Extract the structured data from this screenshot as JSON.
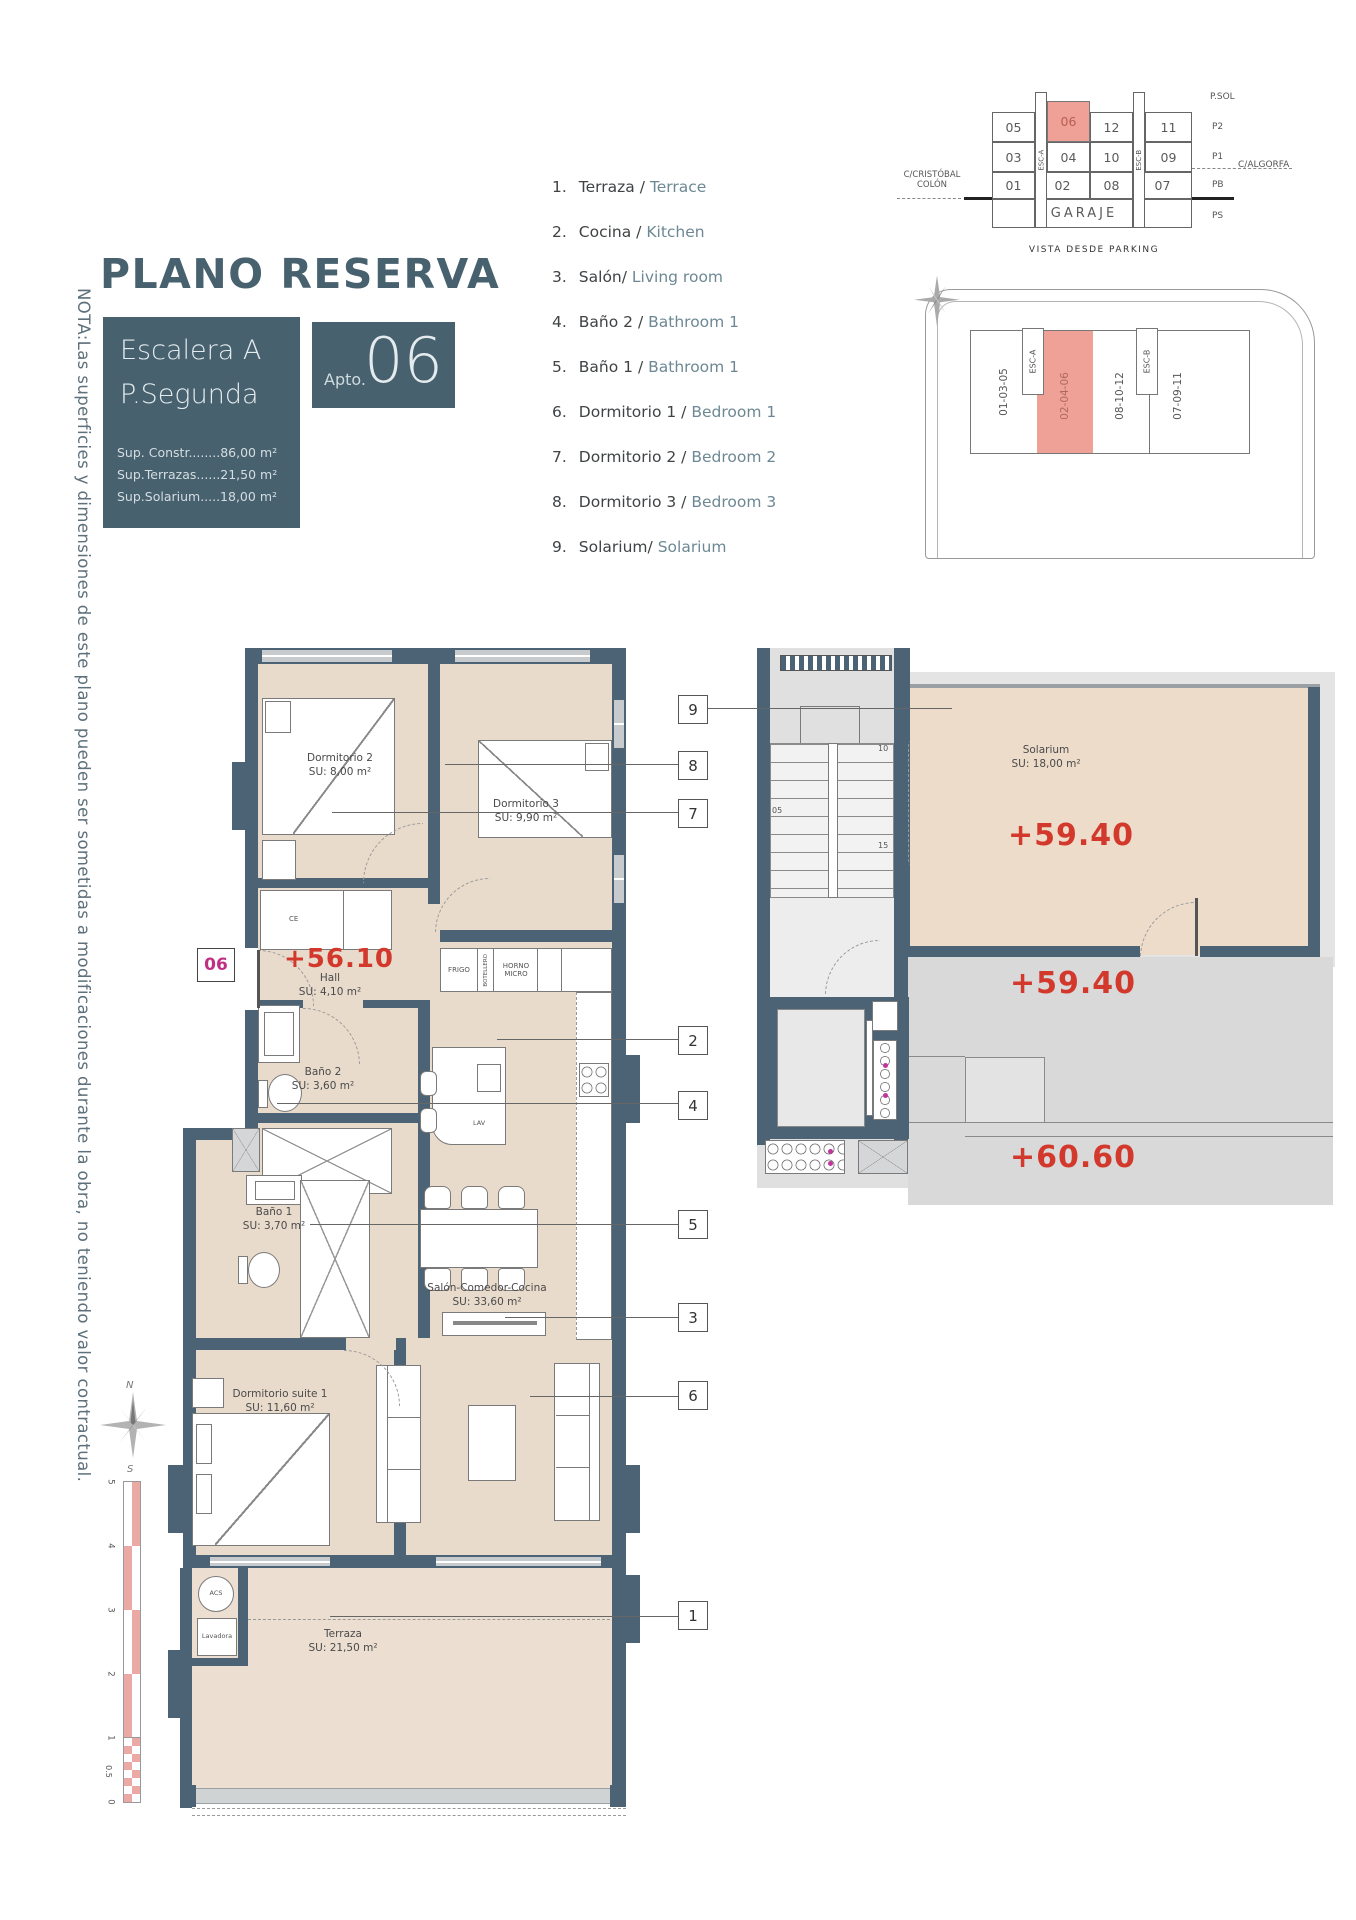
{
  "title": "PLANO RESERVA",
  "note": "NOTA:Las superficies y dimensiones de este plano pueden ser sometidas a modificaciones durante la obra, no teniendo valor contractual.",
  "info_box": {
    "escalera": "Escalera A",
    "planta": "P.Segunda",
    "sup_constr": "Sup. Constr........86,00 m²",
    "sup_terrazas": "Sup.Terrazas......21,50 m²",
    "sup_solarium": "Sup.Solarium.....18,00 m²"
  },
  "apto": {
    "label": "Apto.",
    "number": "06"
  },
  "legend": {
    "items": [
      {
        "num": "1.",
        "es": "Terraza /",
        "en": "Terrace"
      },
      {
        "num": "2.",
        "es": "Cocina /",
        "en": "Kitchen"
      },
      {
        "num": "3.",
        "es": "Salón/",
        "en": "Living room"
      },
      {
        "num": "4.",
        "es": "Baño 2 /",
        "en": "Bathroom 1"
      },
      {
        "num": "5.",
        "es": "Baño 1 /",
        "en": "Bathroom 1"
      },
      {
        "num": "6.",
        "es": "Dormitorio 1 /",
        "en": "Bedroom 1"
      },
      {
        "num": "7.",
        "es": "Dormitorio 2 /",
        "en": "Bedroom 2"
      },
      {
        "num": "8.",
        "es": "Dormitorio 3 /",
        "en": "Bedroom 3"
      },
      {
        "num": "9.",
        "es": "Solarium/",
        "en": "Solarium"
      }
    ]
  },
  "section": {
    "psol": "P.SOL",
    "p2": "P2",
    "p1": "P1",
    "pb": "PB",
    "ps": "PS",
    "esc_a": "ESC-A",
    "esc_b": "ESC-B",
    "garaje": "GARAJE",
    "row_p2": [
      "05",
      "06",
      "12",
      "11"
    ],
    "row_p1": [
      "03",
      "04",
      "10",
      "09"
    ],
    "row_pb": [
      "01",
      "02",
      "08",
      "07"
    ],
    "street_left_1": "C/CRISTÓBAL",
    "street_left_2": "COLÓN",
    "street_right": "C/ALGORFA",
    "caption": "VISTA DESDE PARKING"
  },
  "site": {
    "strip_a": "01-03-05",
    "strip_b": "02-04-06",
    "strip_c": "08-10-12",
    "strip_d": "07-09-11",
    "esc_a": "ESC-A",
    "esc_b": "ESC-B"
  },
  "plan": {
    "unit_tag": "06",
    "level": "+56.10",
    "hall_name": "Hall",
    "hall_su": "SU: 4,10 m²",
    "dorm2_name": "Dormitorio 2",
    "dorm2_su": "SU: 8,00 m²",
    "dorm3_name": "Dormitorio 3",
    "dorm3_su": "SU: 9,90 m²",
    "bano2_name": "Baño 2",
    "bano2_su": "SU: 3,60 m²",
    "bano1_name": "Baño 1",
    "bano1_su": "SU: 3,70 m²",
    "salon_name": "Salón-Comedor-Cocina",
    "salon_su": "SU: 33,60 m²",
    "suite_name": "Dormitorio suite 1",
    "suite_su": "SU: 11,60 m²",
    "terraza_name": "Terraza",
    "terraza_su": "SU: 21,50 m²",
    "ce": "CE",
    "frigo": "FRIGO",
    "botellero": "BOTELLERO",
    "horno_1": "HORNO",
    "horno_2": "MICRO",
    "lav": "LAV",
    "acs": "ACS",
    "lavadora": "Lavadora"
  },
  "solarium": {
    "name": "Solarium",
    "su": "SU: 18,00 m²",
    "level_a": "+59.40",
    "level_b": "+59.40",
    "level_c": "+60.60",
    "barbacoa_1": "PREINSTALACION",
    "barbacoa_2": "BARBACOA",
    "s05": "05",
    "s10": "10",
    "s15": "15",
    "s18": "18"
  },
  "callouts": [
    "9",
    "8",
    "7",
    "2",
    "4",
    "5",
    "3",
    "6",
    "1"
  ],
  "compass": {
    "n": "N",
    "s": "S"
  },
  "scale": {
    "m5": "5",
    "m4": "4",
    "m3": "3",
    "m2": "2",
    "m1": "1",
    "m05": "0.5",
    "m0": "0"
  },
  "colors": {
    "wall": "#4b6374",
    "accent_red": "#d2392c",
    "highlight_pink": "#efa097",
    "magenta": "#c02f84",
    "floor": "#e9dbcc"
  }
}
